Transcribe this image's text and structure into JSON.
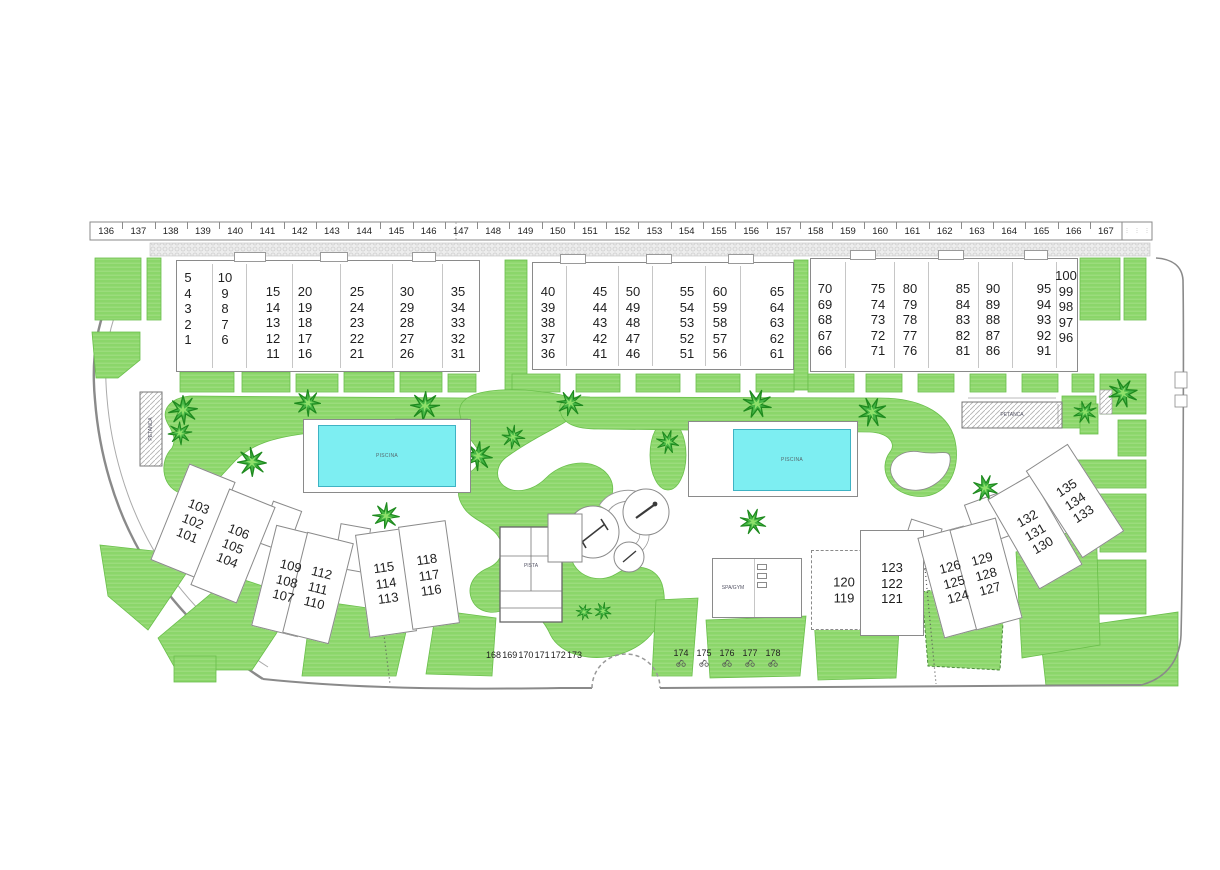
{
  "colors": {
    "grass": "#8bd66a",
    "grass_stripe": "#9fdd80",
    "grass_edge": "#6abf4b",
    "pool_water": "#7deef2",
    "pool_edge": "#3fb3c4",
    "outline": "#8a8a8a",
    "text": "#1f1f1f"
  },
  "parking_top": {
    "numbers": [
      "136",
      "137",
      "138",
      "139",
      "140",
      "141",
      "142",
      "143",
      "144",
      "145",
      "146",
      "147",
      "148",
      "149",
      "150",
      "151",
      "152",
      "153",
      "154",
      "155",
      "156",
      "157",
      "158",
      "159",
      "160",
      "161",
      "162",
      "163",
      "164",
      "165",
      "166",
      "167"
    ],
    "moto_slot_count": 3
  },
  "parking_bottom_left": {
    "numbers": [
      "168",
      "169",
      "170",
      "171",
      "172",
      "173"
    ]
  },
  "parking_bottom_right": {
    "numbers": [
      "174",
      "175",
      "176",
      "177",
      "178"
    ],
    "icon": "moto-icon"
  },
  "upper_blocks": [
    {
      "id": "block-1-35",
      "rect": [
        176,
        260,
        304,
        112
      ],
      "dividers": [
        212,
        246,
        292,
        340,
        392,
        442
      ],
      "bumps": [
        [
          234,
          252,
          32,
          10
        ],
        [
          320,
          252,
          28,
          10
        ],
        [
          412,
          252,
          24,
          10
        ]
      ],
      "columns": [
        {
          "x": 188,
          "y": 270,
          "units": [
            "5",
            "4",
            "3",
            "2",
            "1"
          ]
        },
        {
          "x": 225,
          "y": 270,
          "units": [
            "10",
            "9",
            "8",
            "7",
            "6"
          ]
        },
        {
          "x": 273,
          "y": 284,
          "units": [
            "15",
            "14",
            "13",
            "12",
            "11"
          ]
        },
        {
          "x": 305,
          "y": 284,
          "units": [
            "20",
            "19",
            "18",
            "17",
            "16"
          ]
        },
        {
          "x": 357,
          "y": 284,
          "units": [
            "25",
            "24",
            "23",
            "22",
            "21"
          ]
        },
        {
          "x": 407,
          "y": 284,
          "units": [
            "30",
            "29",
            "28",
            "27",
            "26"
          ]
        },
        {
          "x": 458,
          "y": 284,
          "units": [
            "35",
            "34",
            "33",
            "32",
            "31"
          ]
        }
      ]
    },
    {
      "id": "block-36-65",
      "rect": [
        532,
        262,
        262,
        108
      ],
      "dividers": [
        566,
        618,
        652,
        705,
        740
      ],
      "bumps": [
        [
          560,
          254,
          26,
          10
        ],
        [
          646,
          254,
          26,
          10
        ],
        [
          728,
          254,
          26,
          10
        ]
      ],
      "columns": [
        {
          "x": 548,
          "y": 284,
          "units": [
            "40",
            "39",
            "38",
            "37",
            "36"
          ]
        },
        {
          "x": 600,
          "y": 284,
          "units": [
            "45",
            "44",
            "43",
            "42",
            "41"
          ]
        },
        {
          "x": 633,
          "y": 284,
          "units": [
            "50",
            "49",
            "48",
            "47",
            "46"
          ]
        },
        {
          "x": 687,
          "y": 284,
          "units": [
            "55",
            "54",
            "53",
            "52",
            "51"
          ]
        },
        {
          "x": 720,
          "y": 284,
          "units": [
            "60",
            "59",
            "58",
            "57",
            "56"
          ]
        },
        {
          "x": 777,
          "y": 284,
          "units": [
            "65",
            "64",
            "63",
            "62",
            "61"
          ]
        }
      ]
    },
    {
      "id": "block-66-100",
      "rect": [
        810,
        258,
        268,
        114
      ],
      "dividers": [
        845,
        894,
        928,
        978,
        1012,
        1056
      ],
      "bumps": [
        [
          850,
          250,
          26,
          10
        ],
        [
          938,
          250,
          26,
          10
        ],
        [
          1024,
          250,
          24,
          10
        ]
      ],
      "columns": [
        {
          "x": 825,
          "y": 281,
          "units": [
            "70",
            "69",
            "68",
            "67",
            "66"
          ]
        },
        {
          "x": 878,
          "y": 281,
          "units": [
            "75",
            "74",
            "73",
            "72",
            "71"
          ]
        },
        {
          "x": 910,
          "y": 281,
          "units": [
            "80",
            "79",
            "78",
            "77",
            "76"
          ]
        },
        {
          "x": 963,
          "y": 281,
          "units": [
            "85",
            "84",
            "83",
            "82",
            "81"
          ]
        },
        {
          "x": 993,
          "y": 281,
          "units": [
            "90",
            "89",
            "88",
            "87",
            "86"
          ]
        },
        {
          "x": 1044,
          "y": 281,
          "units": [
            "95",
            "94",
            "93",
            "92",
            "91"
          ]
        },
        {
          "x": 1066,
          "y": 268,
          "units": [
            "100",
            "99",
            "98",
            "97",
            "96"
          ]
        }
      ]
    }
  ],
  "lower_buildings": [
    {
      "units": [
        "103",
        "102",
        "101"
      ],
      "cx": 193,
      "cy": 521,
      "rot": 22,
      "w": 50,
      "h": 104
    },
    {
      "units": [
        "106",
        "105",
        "104"
      ],
      "cx": 233,
      "cy": 546,
      "rot": 22,
      "w": 50,
      "h": 104
    },
    {
      "units": [
        "109",
        "108",
        "107"
      ],
      "cx": 287,
      "cy": 581,
      "rot": 14,
      "w": 48,
      "h": 104
    },
    {
      "units": [
        "112",
        "111",
        "110"
      ],
      "cx": 318,
      "cy": 588,
      "rot": 14,
      "w": 48,
      "h": 104
    },
    {
      "units": [
        "115",
        "114",
        "113"
      ],
      "cx": 386,
      "cy": 583,
      "rot": -8,
      "w": 48,
      "h": 104
    },
    {
      "units": [
        "118",
        "117",
        "116"
      ],
      "cx": 429,
      "cy": 575,
      "rot": -8,
      "w": 48,
      "h": 104
    },
    {
      "units": [
        "120",
        "119"
      ],
      "cx": 844,
      "cy": 590,
      "rot": 0,
      "w": 66,
      "h": 80,
      "dashed": true
    },
    {
      "units": [
        "123",
        "122",
        "121"
      ],
      "cx": 892,
      "cy": 583,
      "rot": 0,
      "w": 64,
      "h": 106
    },
    {
      "units": [
        "126",
        "125",
        "124"
      ],
      "cx": 954,
      "cy": 582,
      "rot": -15,
      "w": 48,
      "h": 104
    },
    {
      "units": [
        "129",
        "128",
        "127"
      ],
      "cx": 986,
      "cy": 574,
      "rot": -15,
      "w": 48,
      "h": 104
    },
    {
      "units": [
        "132",
        "131",
        "130"
      ],
      "cx": 1035,
      "cy": 532,
      "rot": -30,
      "w": 50,
      "h": 104
    },
    {
      "units": [
        "135",
        "134",
        "133"
      ],
      "cx": 1075,
      "cy": 501,
      "rot": -33,
      "w": 50,
      "h": 104
    }
  ],
  "pools": [
    {
      "deck": [
        303,
        419,
        168,
        74
      ],
      "water": [
        318,
        425,
        138,
        62
      ],
      "label": "PISCINA"
    },
    {
      "deck": [
        688,
        421,
        170,
        76
      ],
      "water": [
        733,
        429,
        118,
        62
      ],
      "label": "PISCINA"
    }
  ],
  "amenities": {
    "tennis": {
      "label": "PISTA"
    },
    "spa": {
      "label": "SPA/GYM"
    },
    "petanca": {
      "label": "PETANCA"
    },
    "petanca_left": {
      "label": "PETANCA"
    }
  },
  "trees": [
    [
      183,
      410,
      1.0
    ],
    [
      180,
      433,
      0.8
    ],
    [
      252,
      462,
      1.0
    ],
    [
      308,
      403,
      0.9
    ],
    [
      425,
      406,
      1.0
    ],
    [
      386,
      516,
      0.9
    ],
    [
      478,
      456,
      1.0
    ],
    [
      513,
      437,
      0.8
    ],
    [
      570,
      403,
      0.9
    ],
    [
      584,
      612,
      0.55
    ],
    [
      603,
      611,
      0.6
    ],
    [
      668,
      442,
      0.8
    ],
    [
      757,
      404,
      1.0
    ],
    [
      753,
      522,
      0.9
    ],
    [
      872,
      412,
      1.0
    ],
    [
      985,
      488,
      0.9
    ],
    [
      1085,
      412,
      0.8
    ],
    [
      1123,
      393,
      1.0
    ]
  ]
}
